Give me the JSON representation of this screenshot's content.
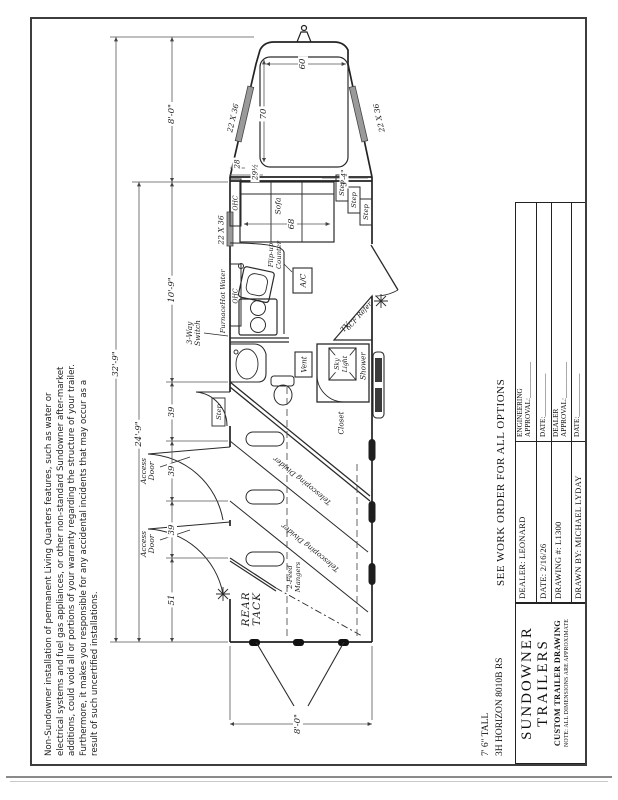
{
  "disclaimer": "Non-Sundowner installation of permanent Living Quarters features, such as water or\nelectrical systems and fuel gas appliances, or other non-standard Sundowner after-market\nadditions, could void all or portions of your warranty regarding the structure of your trailer.\nFurthermore, it makes you responsible for any accidental incidents that may occur as a\nresult of such uncertified installations.",
  "title_block": {
    "model_height": "7' 6\" TALL",
    "model": "3H HORIZON 8010B RS",
    "see_note": "SEE WORK ORDER FOR ALL OPTIONS",
    "company_line1": "SUNDOWNER",
    "company_line2": "TRAILERS",
    "drawing_type": "CUSTOM TRAILER DRAWING",
    "note": "NOTE: ALL DIMENSIONS ARE APPROXIMATE",
    "dealer": "DEALER: LEONARD",
    "date": "DATE: 2/16/26",
    "drawing_no": "DRAWING #: L1300",
    "drawn_by": "DRAWN BY: MICHAEL LYDAY",
    "eng_approval": "ENGINEERING\nAPPROVAL:__________",
    "approval_date": "DATE:____________",
    "dealer_approval": "DEALER\nAPPROVAL:__________"
  },
  "dimensions": {
    "overall_length": "32'-9\"",
    "floor_length": "24'-9\"",
    "lq_length": "10'-9\"",
    "gooseneck_length": "8'-0\"",
    "rear_width": "8'-0\"",
    "stall_width": "39",
    "rear_tack_length": "51",
    "bed_width": "60",
    "bed_length": "70",
    "sofa_length": "68",
    "dim_28": "28",
    "dim_29half": "29½",
    "dim_3_4": "3'-4\""
  },
  "labels": {
    "window_size": "22 X 36",
    "hot_water": "Hot Water",
    "furnace": "Furnace",
    "ohc": "OHC",
    "flip_counter": "Flip-up\nCounter",
    "three_way_switch": "3-Way\nSwitch",
    "sofa": "Sofa",
    "step": "Step",
    "ac": "A/C",
    "vent": "Vent",
    "tv": "TV",
    "refer": "6CF Refer",
    "shower": "Shower",
    "skylight": "Sky\nLight",
    "closet": "Closet",
    "access_door": "Access\nDoor",
    "telescoping_divider": "Telescoping Divider",
    "feed_mangers": "2-Feed\nMangers",
    "rear_tack": "REAR\nTACK"
  }
}
